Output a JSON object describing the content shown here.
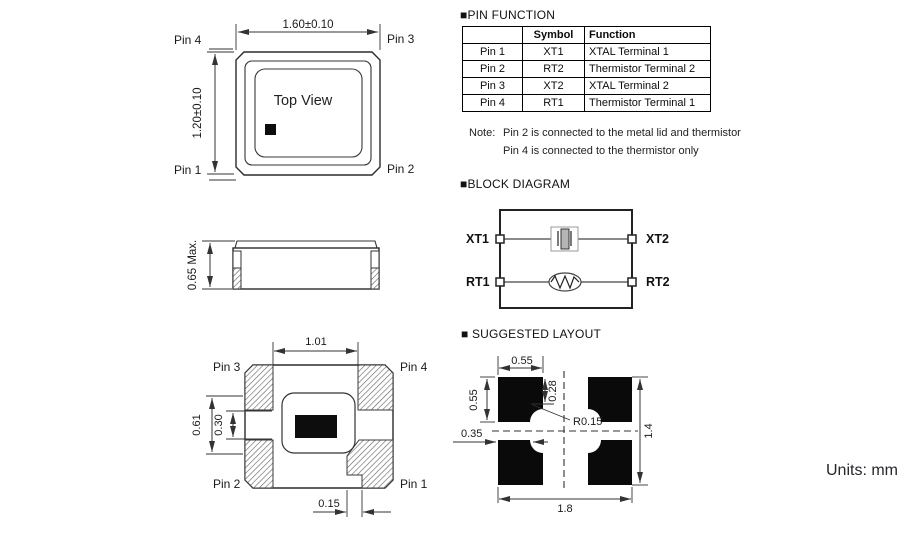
{
  "page": {
    "units_label": "Units: mm"
  },
  "top_view": {
    "dim_width": "1.60±0.10",
    "dim_height": "1.20±0.10",
    "center_label": "Top View",
    "pin_top_left": "Pin 4",
    "pin_top_right": "Pin 3",
    "pin_bottom_left": "Pin 1",
    "pin_bottom_right": "Pin 2"
  },
  "side_view": {
    "dim_height": "0.65 Max."
  },
  "bottom_view": {
    "dim_top": "1.01",
    "dim_outer": "0.61",
    "dim_inner": "0.30",
    "dim_notch": "0.15",
    "pin_top_left": "Pin 3",
    "pin_top_right": "Pin 4",
    "pin_bottom_left": "Pin 2",
    "pin_bottom_right": "Pin 1"
  },
  "pin_function": {
    "title": "■PIN FUNCTION",
    "headers": [
      "",
      "Symbol",
      "Function"
    ],
    "rows": [
      [
        "Pin 1",
        "XT1",
        "XTAL Terminal 1"
      ],
      [
        "Pin 2",
        "RT2",
        "Thermistor Terminal 2"
      ],
      [
        "Pin 3",
        "XT2",
        "XTAL Terminal 2"
      ],
      [
        "Pin 4",
        "RT1",
        "Thermistor Terminal 1"
      ]
    ],
    "note_label": "Note:",
    "note_line1": "Pin 2 is connected to the metal lid and thermistor",
    "note_line2": "Pin 4 is connected to the thermistor only"
  },
  "block_diagram": {
    "title": "■BLOCK DIAGRAM",
    "xt1": "XT1",
    "xt2": "XT2",
    "rt1": "RT1",
    "rt2": "RT2"
  },
  "layout": {
    "title": "■ SUGGESTED LAYOUT",
    "dim_pad_w": "0.55",
    "dim_pad_h": "0.55",
    "dim_notch": "0.28",
    "dim_radius": "R0.15",
    "dim_offset": "0.35",
    "dim_total_h": "1.4",
    "dim_total_w": "1.8"
  }
}
